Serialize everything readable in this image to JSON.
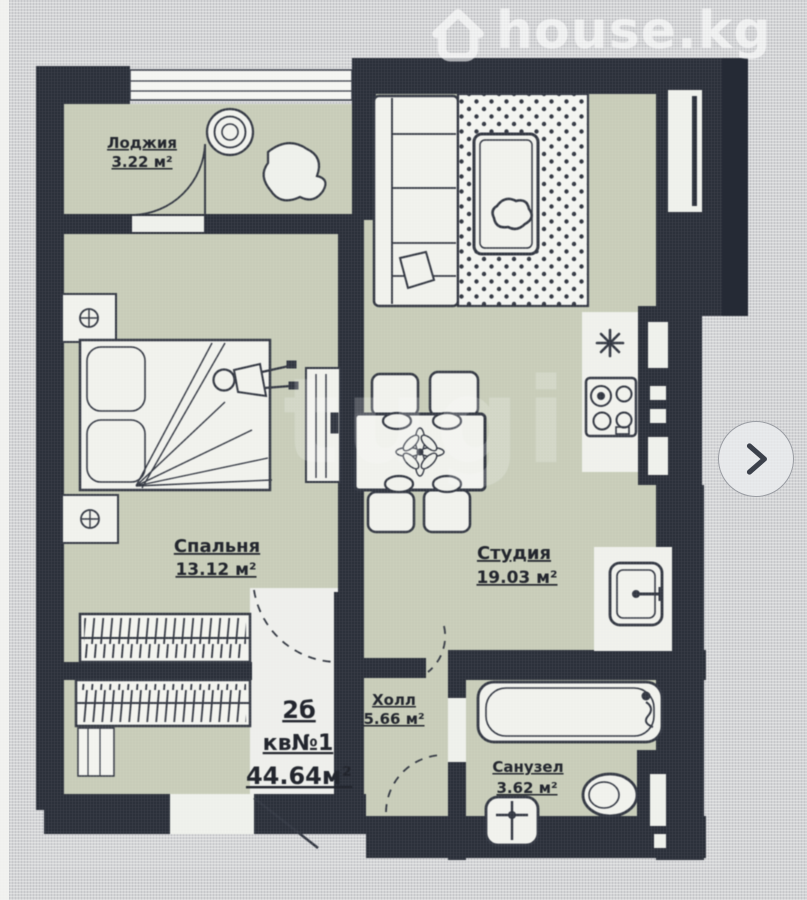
{
  "watermarks": {
    "brand": "house.kg",
    "center": "tugi"
  },
  "gallery": {
    "next_icon": "chevron-right"
  },
  "floor_plan": {
    "rooms": [
      {
        "name": "Лоджия",
        "area": "3.22 м²"
      },
      {
        "name": "Спальня",
        "area": "13.12 м²"
      },
      {
        "name": "Студия",
        "area": "19.03 м²"
      },
      {
        "name": "Холл",
        "area": "5.66 м²"
      },
      {
        "name": "Санузел",
        "area": "3.62 м²"
      }
    ],
    "apartment": {
      "type_label": "2б",
      "unit_label": "кв№1",
      "total_area_label": "44.64м²"
    }
  },
  "colors": {
    "wall": "#252a35",
    "floor_green": "#c6cbb7",
    "floor_light": "#edeeea",
    "background": "#d3d4d6"
  }
}
